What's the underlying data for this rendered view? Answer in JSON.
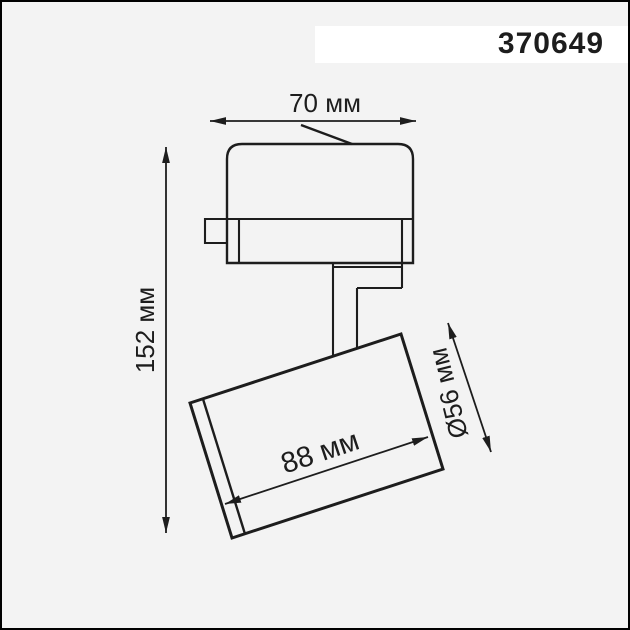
{
  "colors": {
    "background": "#f3f3f3",
    "border": "#000000",
    "line": "#1d1d1d",
    "label_box": "#ffffff"
  },
  "product": {
    "code": "370649"
  },
  "dimension_labels": {
    "overall_width": "70 мм",
    "overall_height": "152 мм",
    "head_length": "88 мм",
    "head_diameter": "Ø56 мм"
  },
  "dimensions_mm": {
    "overall_width": 70,
    "overall_height": 152,
    "head_length": 88,
    "head_diameter": 56
  }
}
